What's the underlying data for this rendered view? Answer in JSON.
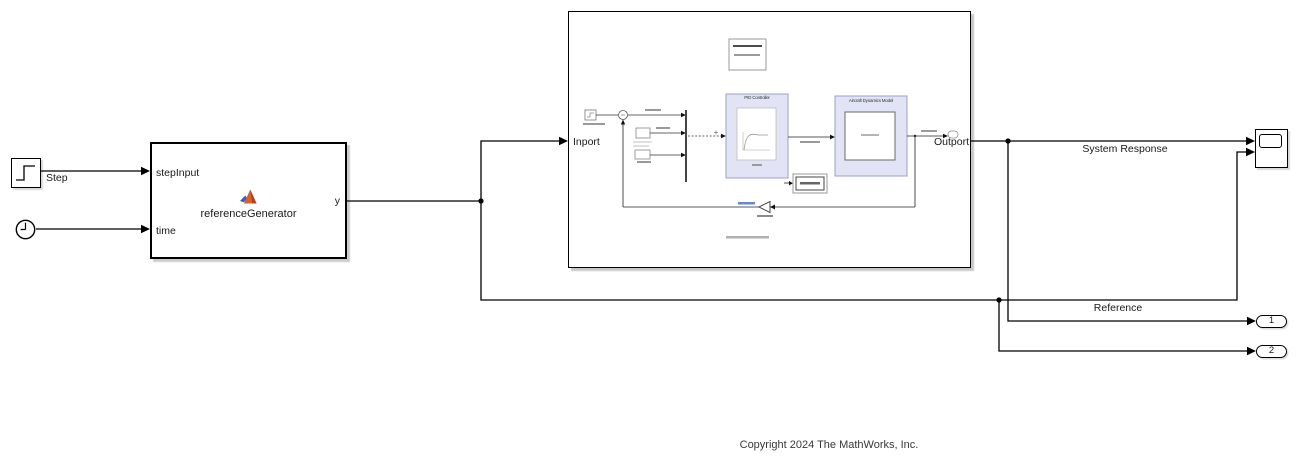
{
  "window": {
    "copyright": "Copyright 2024 The MathWorks, Inc."
  },
  "blocks": {
    "step": {
      "label": "Step"
    },
    "reference_generator": {
      "label": "referenceGenerator",
      "in1": "stepInput",
      "in2": "time",
      "out1": "y"
    },
    "model": {
      "inport": "Inport",
      "outport": "Outport",
      "preview": {
        "controller": "PID Controller",
        "plant": "Aircraft Dynamics Model"
      }
    },
    "outport1": "1",
    "outport2": "2"
  },
  "signals": {
    "system_response": "System Response",
    "reference": "Reference"
  },
  "colors": {
    "wire": "#000000",
    "preview_fill": "#e2e4f6",
    "preview_border": "#9aa0c8",
    "matlab_orange": "#d95f2b",
    "matlab_blue": "#3f5fae"
  }
}
